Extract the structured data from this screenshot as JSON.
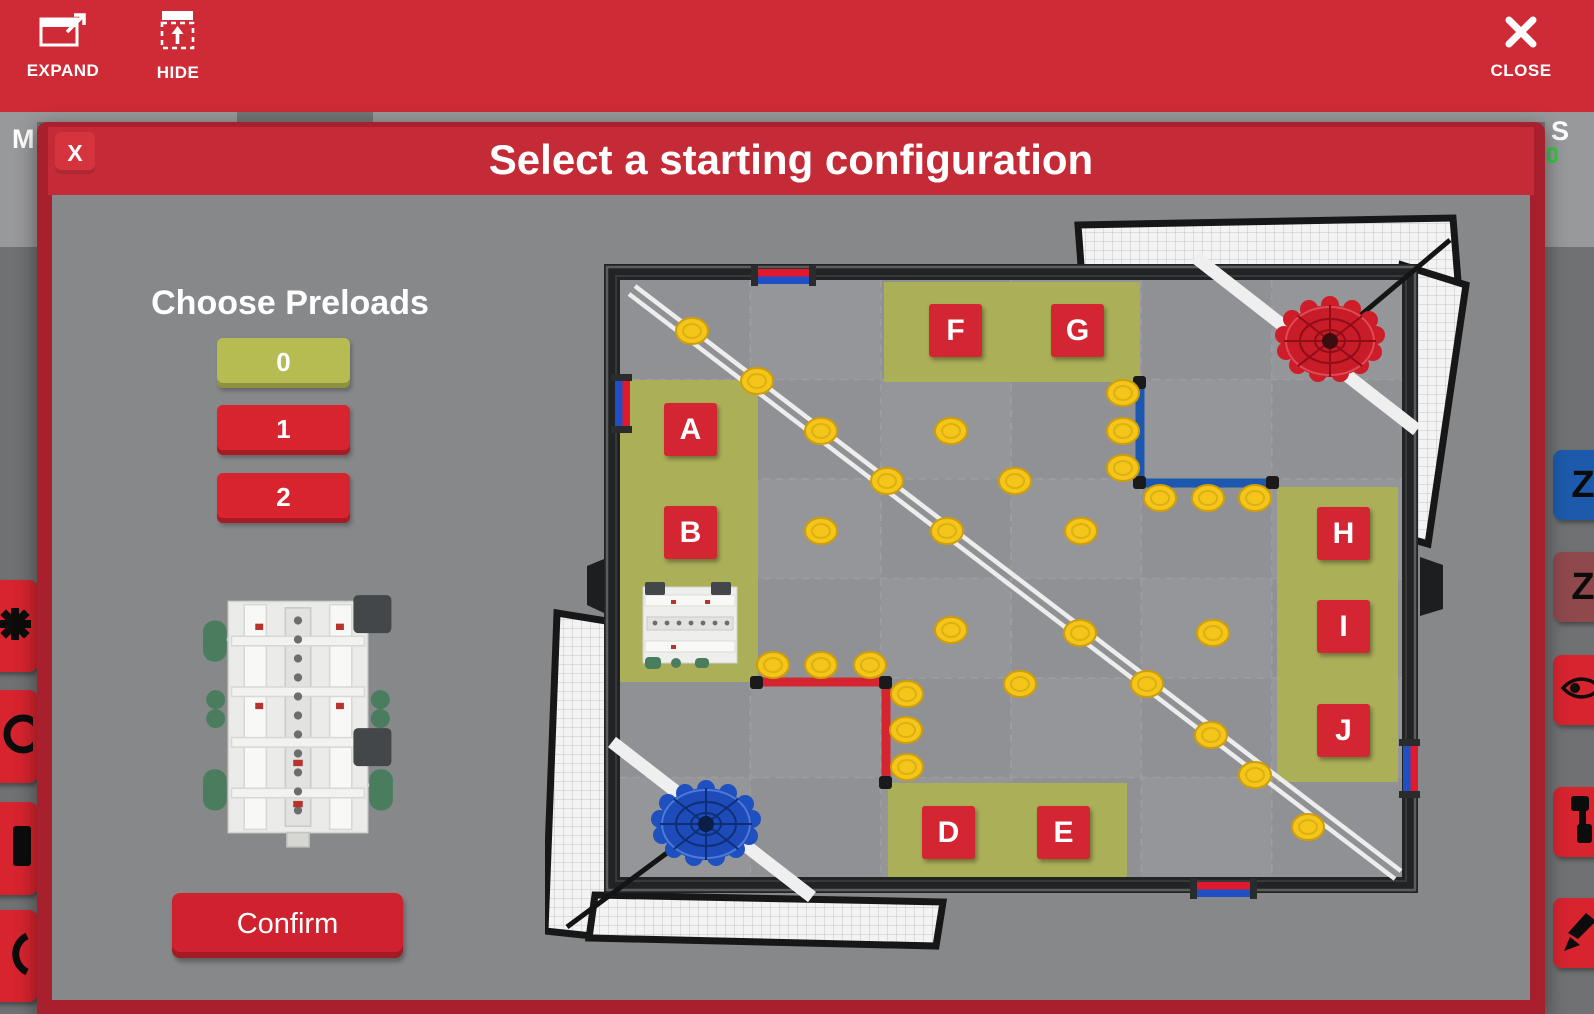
{
  "toolbar": {
    "expand_label": "EXPAND",
    "hide_label": "HIDE",
    "close_label": "CLOSE",
    "expand_icon": "expand-window-icon",
    "hide_icon": "hide-panel-icon",
    "close_icon": "x-icon"
  },
  "background": {
    "left_panel_letter": "M",
    "right_panel_letter": "S",
    "right_panel_number": "0",
    "left_buttons": [
      {
        "icon": "gear-icon"
      },
      {
        "icon": "circle-icon"
      },
      {
        "icon": "panel-icon"
      },
      {
        "icon": "crescent-icon"
      }
    ],
    "right_buttons": [
      {
        "icon": "z-letter-icon",
        "label": "Z",
        "color": "#1d5aab"
      },
      {
        "icon": "z-letter-icon",
        "label": "Z",
        "color": "#8f494d"
      },
      {
        "icon": "eye-icon",
        "label": "",
        "color": "#d7242f"
      },
      {
        "icon": "link-icon",
        "label": "",
        "color": "#d7242f"
      },
      {
        "icon": "draw-icon",
        "label": "",
        "color": "#d7242f"
      }
    ]
  },
  "modal": {
    "title": "Select a starting configuration",
    "close_label": "X",
    "preloads": {
      "heading": "Choose Preloads",
      "options": [
        "0",
        "1",
        "2"
      ],
      "selected_index": 0
    },
    "confirm_label": "Confirm"
  },
  "field": {
    "positions": [
      "A",
      "B",
      "D",
      "E",
      "F",
      "G",
      "H",
      "I",
      "J"
    ]
  },
  "colors": {
    "toolbar_red": "#cf2b36",
    "modal_border_red": "#a8202e",
    "accent_red": "#d7242f",
    "selected_olive": "#b6bc52",
    "zone_olive": "#adb251",
    "disc_yellow": "#f4c51a",
    "alliance_red": "#d42531",
    "alliance_blue": "#1c57b0",
    "field_gray": "#909194"
  }
}
